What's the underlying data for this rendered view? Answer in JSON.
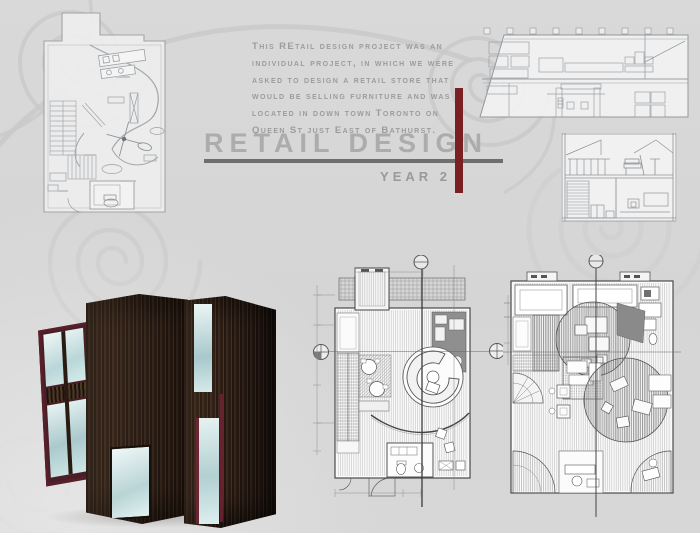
{
  "title": {
    "main": "RETAIL DESIGN",
    "sub": "YEAR 2"
  },
  "intro": {
    "lines": [
      "This REtail design project was an",
      "individual project, in which we were",
      "asked to design a retail store that",
      "would be selling furniture and was",
      "located in down town Toronto on",
      "Queen St just East of Bathurst."
    ]
  },
  "colors": {
    "background": "#d6d6d6",
    "accent_red": "#7a2023",
    "rule_gray": "#6e6e6e",
    "body_text": "#9c9c9c",
    "title_text": "#acacac",
    "drawing_line": "#8e9296",
    "glass_blue": "#cfe6e8",
    "wood_dark": "#2e2018",
    "swirl_gray": "#c9c9c9"
  }
}
